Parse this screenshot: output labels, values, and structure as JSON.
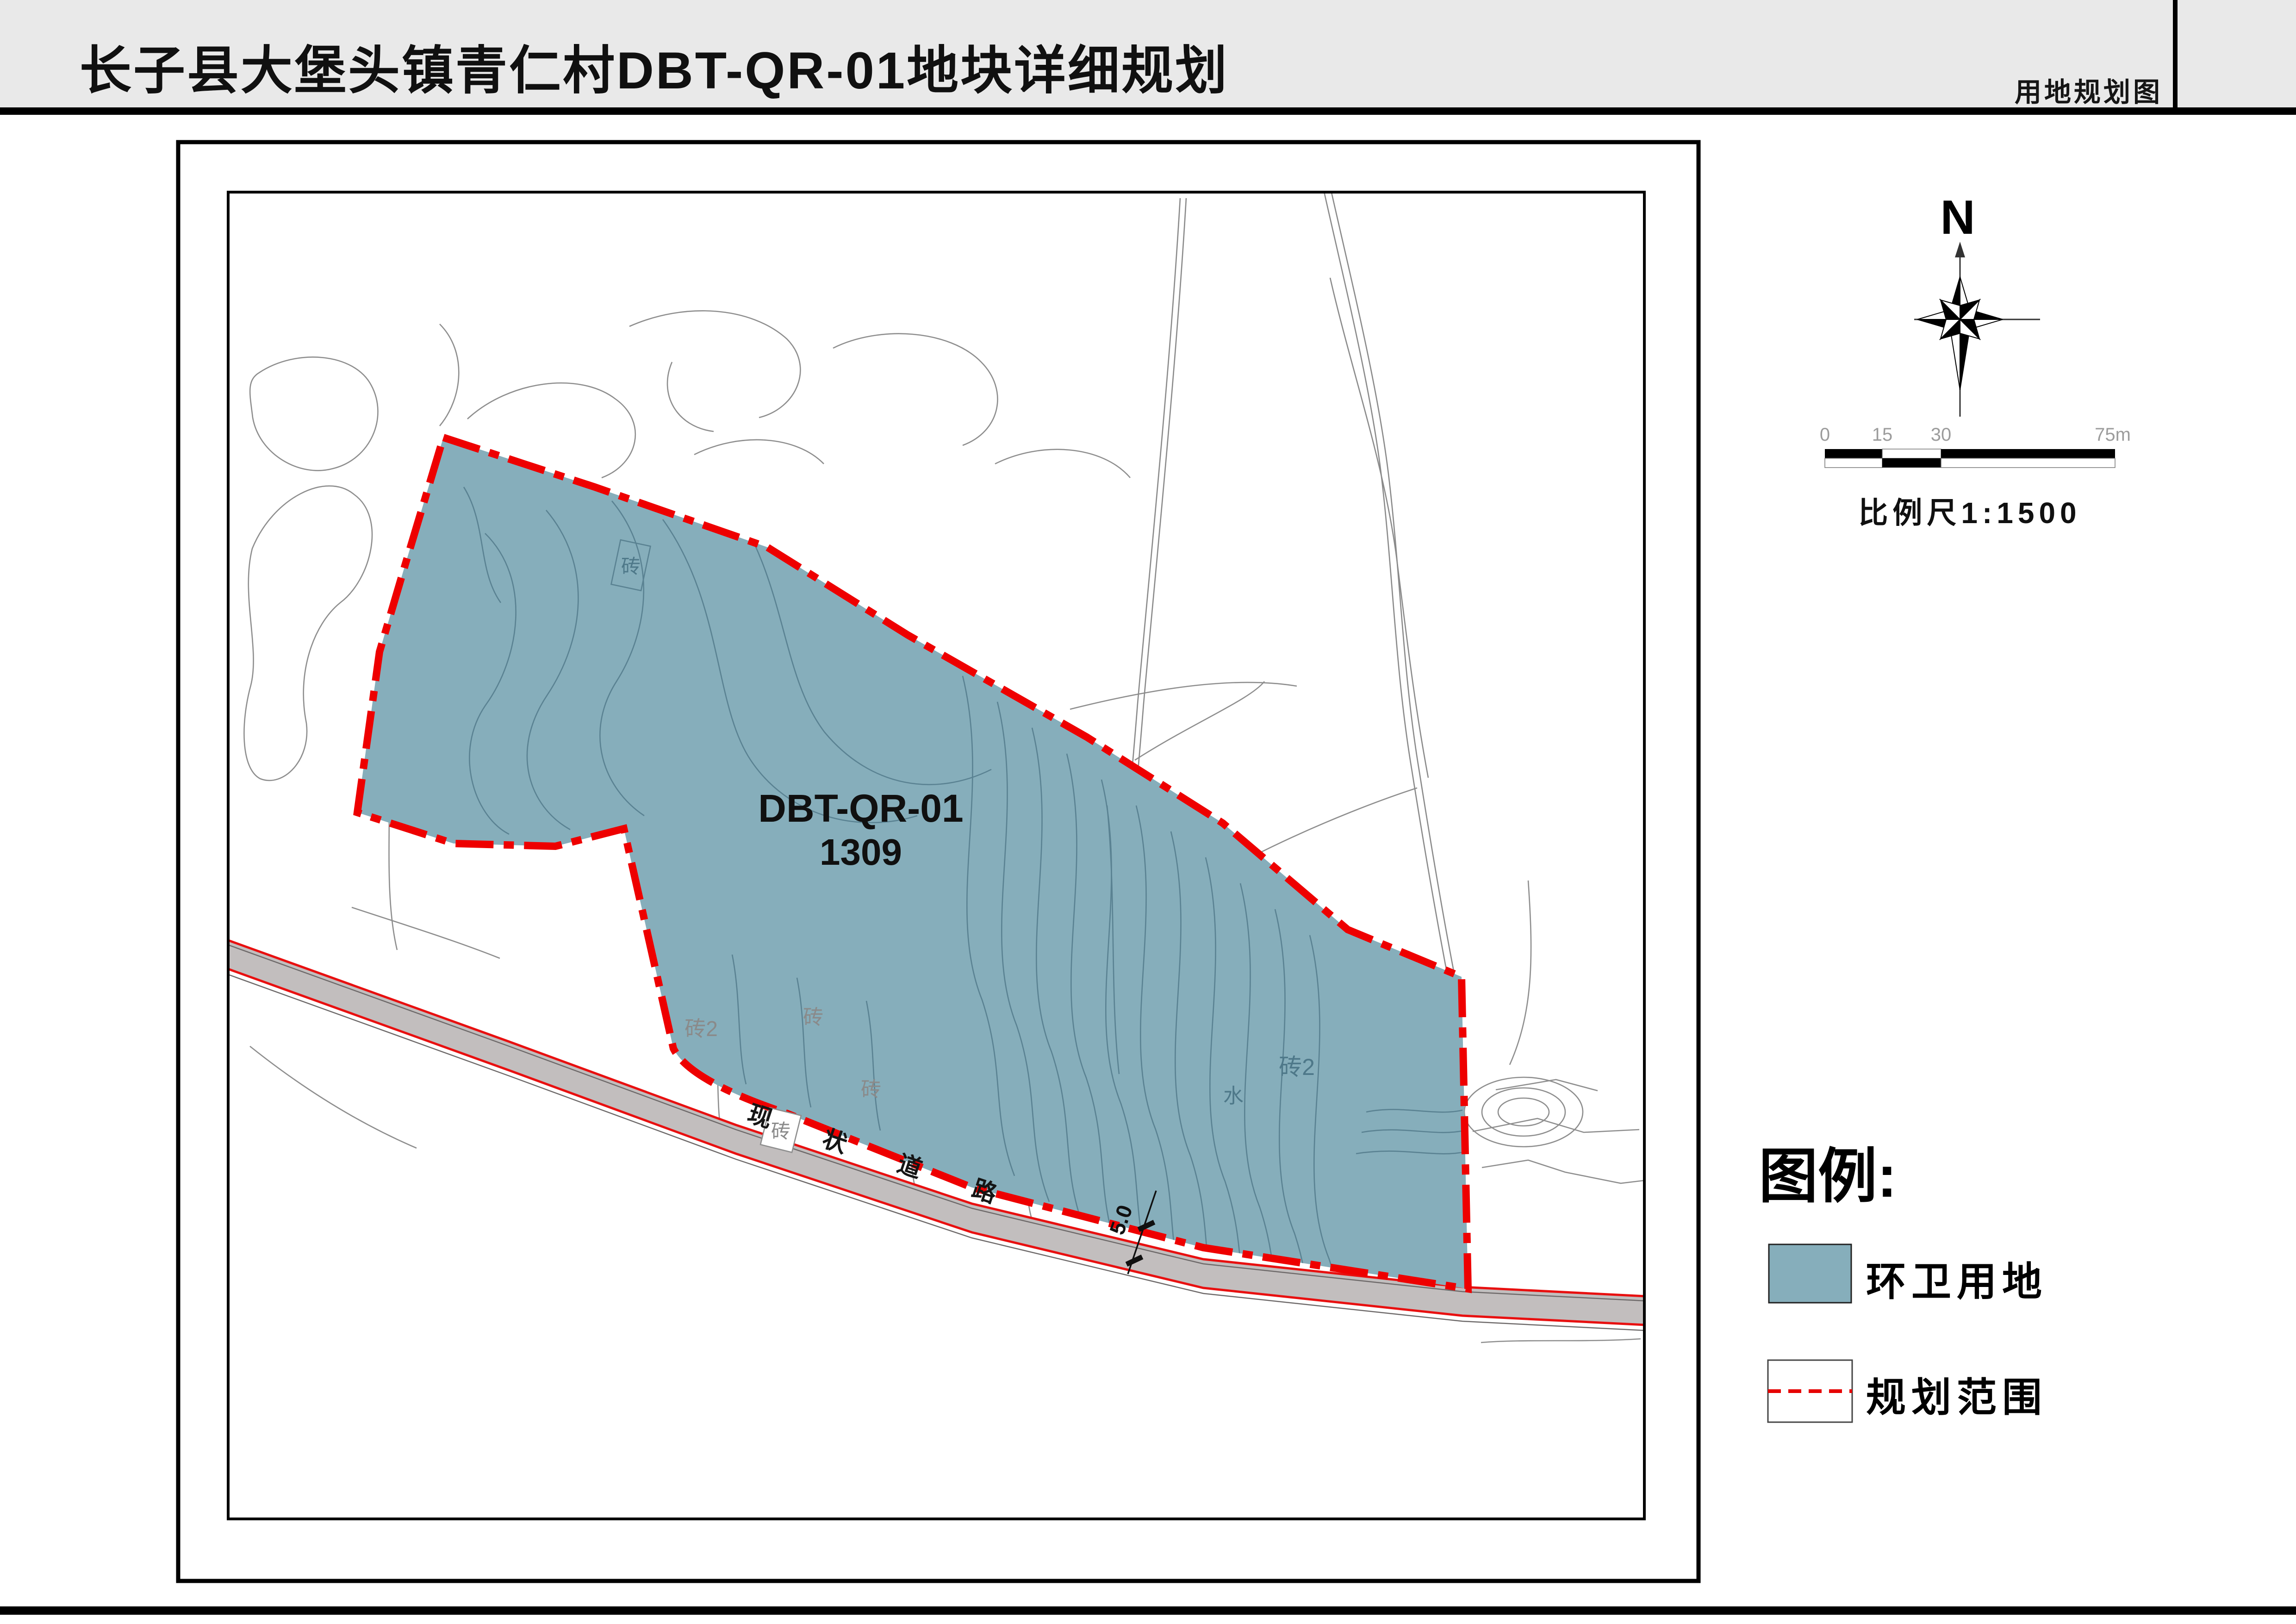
{
  "header": {
    "title": "长子县大堡头镇青仁村DBT-QR-01地块详细规划",
    "sheet_label": "用地规划图"
  },
  "map": {
    "parcel_code": "DBT-QR-01",
    "parcel_number": "1309",
    "road_name": "现 状 道 路",
    "road_width": "5.0",
    "site_labels": {
      "brick": "砖",
      "brick2": "砖2",
      "water": "水"
    }
  },
  "north_arrow": {
    "label": "N"
  },
  "scale_bar": {
    "ticks": [
      "0",
      "15",
      "30",
      "75m"
    ],
    "caption": "比例尺1:1500"
  },
  "legend": {
    "title": "图例:",
    "items": [
      {
        "label": "环卫用地",
        "swatch": "blue-fill"
      },
      {
        "label": "规划范围",
        "swatch": "red-dashed-line"
      }
    ]
  },
  "colors": {
    "header_bg": "#E9E9E9",
    "parcel_fill": "#86AEBB",
    "boundary_red": "#EE0000",
    "road_fill": "#C2BEBE",
    "road_edge_red": "#E81010",
    "contour_gray": "#8E8E8E",
    "contour_teal": "#5A8292",
    "label_gray": "#8A8A8A"
  }
}
